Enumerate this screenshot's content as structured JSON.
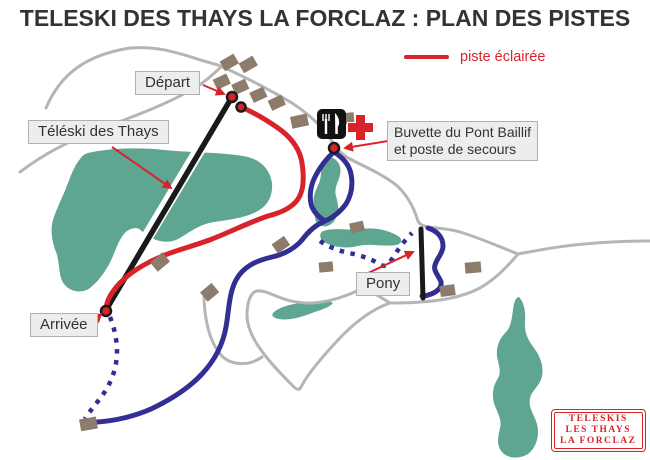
{
  "title": "TELESKI DES THAYS LA FORCLAZ : PLAN DES PISTES",
  "legend": {
    "label": "piste éclairée"
  },
  "labels": {
    "depart": "Départ",
    "teleski": "Téléski des Thays",
    "buvette_line1": "Buvette du Pont Baillif",
    "buvette_line2": "et poste de secours",
    "pony": "Pony",
    "arrivee": "Arrivée"
  },
  "logo": {
    "line1": "TELESKIS",
    "line2": "LES THAYS",
    "line3": "LA FORCLAZ"
  },
  "icons": {
    "restaurant": "fork-and-knife-icon",
    "first_aid": "red-cross-icon"
  },
  "colors": {
    "lit_piste_red": "#d9232a",
    "piste_blue": "#332e91",
    "forest_green": "#5fa692",
    "road_gray": "#b5b5b5",
    "building_brown": "#8d7c6c",
    "lift_black": "#1a1a1a",
    "label_background": "#ededed",
    "title_color": "#333333"
  }
}
